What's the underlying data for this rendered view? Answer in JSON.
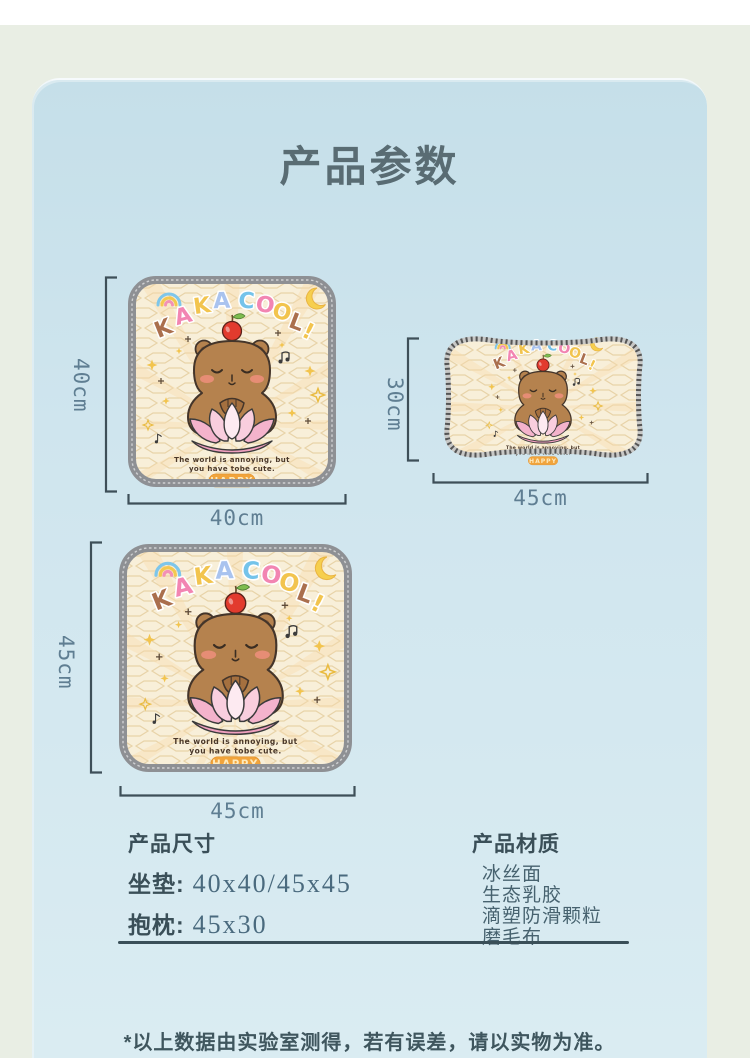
{
  "page": {
    "title": "产品参数",
    "disclaimer": "*以上数据由实验室测得，若有误差，请以实物为准。"
  },
  "products": {
    "cushion_small": {
      "width_label": "40cm",
      "height_label": "40cm"
    },
    "pillow": {
      "width_label": "45cm",
      "height_label": "30cm"
    },
    "cushion_large": {
      "width_label": "45cm",
      "height_label": "45cm"
    }
  },
  "artwork": {
    "letters": [
      "K",
      "A",
      "K",
      "A",
      "C",
      "O",
      "O",
      "L",
      "!"
    ],
    "caption_line1": "The world is annoying, but",
    "caption_line2": "you have tobe cute.",
    "badge": "HAPPY"
  },
  "specs": {
    "heading": "产品尺寸",
    "rows": [
      {
        "label": "坐垫:",
        "value": "40x40/45x45"
      },
      {
        "label": "抱枕:",
        "value": "45x30"
      }
    ]
  },
  "materials": {
    "heading": "产品材质",
    "items": [
      "冰丝面",
      "生态乳胶",
      "滴塑防滑颗粒",
      "磨毛布"
    ]
  },
  "colors": {
    "card_blue": "#c5dfe9",
    "background_green": "#e9eee4",
    "fabric_cream": "#f8efd9",
    "border_gray": "#8e9094",
    "ink_slate": "#3a4f58",
    "dim_blue": "#5f7e92",
    "capybara_brown": "#b5824e",
    "lotus_pink": "#f4b3cc",
    "badge_orange": "#f1a43c"
  }
}
